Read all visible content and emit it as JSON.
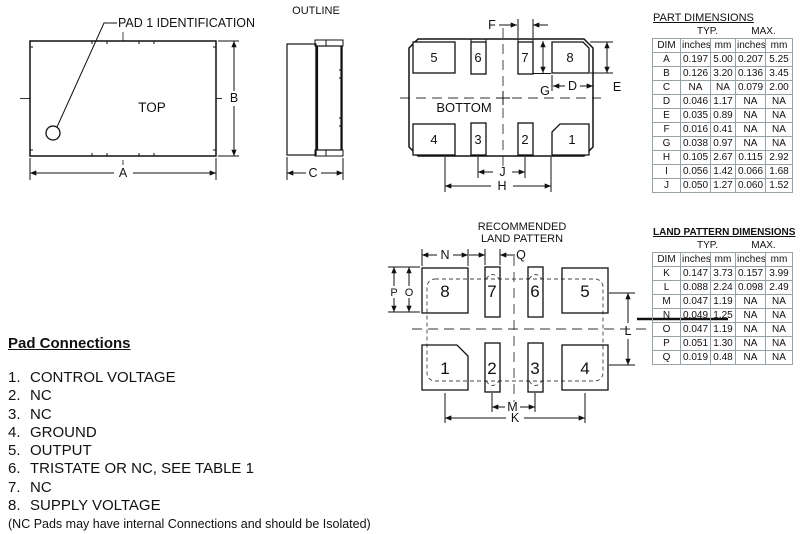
{
  "top_view": {
    "title": "TOP",
    "callout": "PAD 1 IDENTIFICATION",
    "dims": {
      "a": "A",
      "b": "B"
    }
  },
  "outline_view": {
    "title": "OUTLINE",
    "dims": {
      "c": "C"
    }
  },
  "bottom_view": {
    "title": "BOTTOM",
    "dims": {
      "d": "D",
      "e": "E",
      "f": "F",
      "g": "G",
      "h": "H",
      "j": "J"
    },
    "pads_top": [
      "5",
      "6",
      "7",
      "8"
    ],
    "pads_bottom": [
      "4",
      "3",
      "2",
      "1"
    ]
  },
  "land_pattern": {
    "title_line1": "RECOMMENDED",
    "title_line2": "LAND PATTERN",
    "dims": {
      "k": "K",
      "l": "L",
      "m": "M",
      "n": "N",
      "o": "O",
      "p": "P",
      "q": "Q"
    },
    "pads_top": [
      "8",
      "7",
      "6",
      "5"
    ],
    "pads_bottom": [
      "1",
      "2",
      "3",
      "4"
    ]
  },
  "part_dimensions_table": {
    "title": "PART DIMENSIONS",
    "group_headers": [
      "TYP.",
      "MAX."
    ],
    "columns": [
      "DIM",
      "inches",
      "mm",
      "inches",
      "mm"
    ],
    "rows": [
      [
        "A",
        "0.197",
        "5.00",
        "0.207",
        "5.25"
      ],
      [
        "B",
        "0.126",
        "3.20",
        "0.136",
        "3.45"
      ],
      [
        "C",
        "NA",
        "NA",
        "0.079",
        "2.00"
      ],
      [
        "D",
        "0.046",
        "1.17",
        "NA",
        "NA"
      ],
      [
        "E",
        "0.035",
        "0.89",
        "NA",
        "NA"
      ],
      [
        "F",
        "0.016",
        "0.41",
        "NA",
        "NA"
      ],
      [
        "G",
        "0.038",
        "0.97",
        "NA",
        "NA"
      ],
      [
        "H",
        "0.105",
        "2.67",
        "0.115",
        "2.92"
      ],
      [
        "I",
        "0.056",
        "1.42",
        "0.066",
        "1.68"
      ],
      [
        "J",
        "0.050",
        "1.27",
        "0.060",
        "1.52"
      ]
    ]
  },
  "land_pattern_dimensions_table": {
    "title": "LAND PATTERN DIMENSIONS",
    "group_headers": [
      "TYP.",
      "MAX."
    ],
    "columns": [
      "DIM",
      "inches",
      "mm",
      "inches",
      "mm"
    ],
    "rows": [
      [
        "K",
        "0.147",
        "3.73",
        "0.157",
        "3.99"
      ],
      [
        "L",
        "0.088",
        "2.24",
        "0.098",
        "2.49"
      ],
      [
        "M",
        "0.047",
        "1.19",
        "NA",
        "NA"
      ],
      [
        "N",
        "0.049",
        "1.25",
        "NA",
        "NA"
      ],
      [
        "O",
        "0.047",
        "1.19",
        "NA",
        "NA"
      ],
      [
        "P",
        "0.051",
        "1.30",
        "NA",
        "NA"
      ],
      [
        "Q",
        "0.019",
        "0.48",
        "NA",
        "NA"
      ]
    ]
  },
  "pad_connections": {
    "title": "Pad Connections",
    "items": [
      {
        "num": "1.",
        "label": "CONTROL VOLTAGE"
      },
      {
        "num": "2.",
        "label": "NC"
      },
      {
        "num": "3.",
        "label": "NC"
      },
      {
        "num": "4.",
        "label": "GROUND"
      },
      {
        "num": "5.",
        "label": "OUTPUT"
      },
      {
        "num": "6.",
        "label": "TRISTATE OR NC, SEE TABLE 1"
      },
      {
        "num": "7.",
        "label": "NC"
      },
      {
        "num": "8.",
        "label": "SUPPLY VOLTAGE"
      }
    ],
    "note": "(NC Pads may have internal Connections and should be Isolated)"
  },
  "colors": {
    "line": "#111111",
    "table_border": "#97a1a8",
    "background": "#ffffff"
  }
}
